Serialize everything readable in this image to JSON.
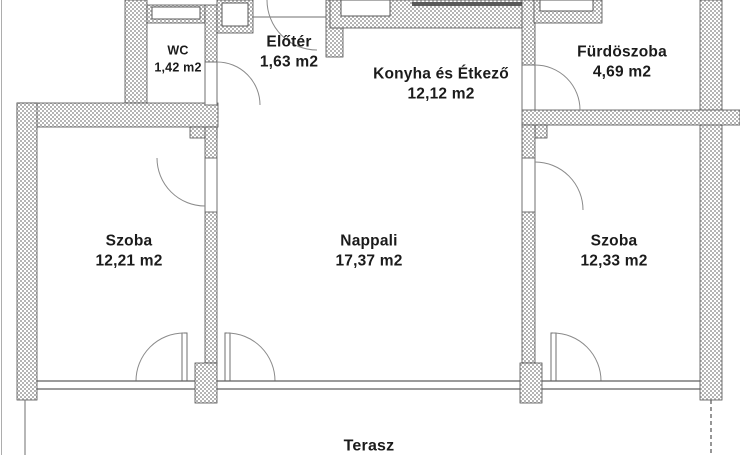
{
  "floor_plan": {
    "rooms": [
      {
        "key": "wc",
        "name": "WC",
        "area": "1,42 m2"
      },
      {
        "key": "elotér",
        "name": "Előtér",
        "area": "1,63 m2"
      },
      {
        "key": "konyha",
        "name": "Konyha és Étkező",
        "area": "12,12 m2"
      },
      {
        "key": "furdoszoba",
        "name": "Fürdöszoba",
        "area": "4,69 m2"
      },
      {
        "key": "szoba_bal",
        "name": "Szoba",
        "area": "12,21 m2"
      },
      {
        "key": "nappali",
        "name": "Nappali",
        "area": "17,37 m2"
      },
      {
        "key": "szoba_jobb",
        "name": "Szoba",
        "area": "12,33 m2"
      },
      {
        "key": "terasz",
        "name": "Terasz",
        "area": ""
      }
    ],
    "colors": {
      "wall_hatch": "#b4b4b4",
      "wall_outline": "#4f4f4f",
      "line": "#5f5f5f",
      "text": "#1b1b1b",
      "background": "#ffffff"
    }
  }
}
